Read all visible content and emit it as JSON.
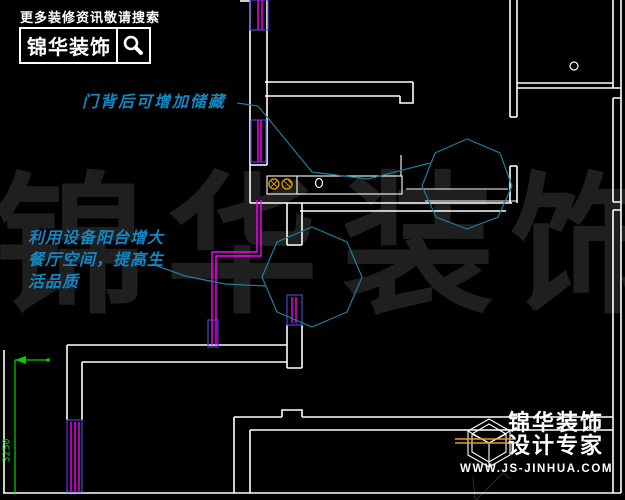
{
  "branding_top": {
    "tagline": "更多装修资讯敬请搜索",
    "brand_name": "锦华装饰",
    "search_icon": "magnifier-icon"
  },
  "annotations": {
    "note1": "门背后可增加储藏",
    "note2_line1": "利用设备阳台增大",
    "note2_line2": "餐厅空间，提高生",
    "note2_line3": "活品质",
    "text_color": "#1486c2",
    "line_color": "#1b7f9e"
  },
  "watermark": {
    "chars": [
      "锦",
      "华",
      "装",
      "饰"
    ],
    "color": "#1f1f1f"
  },
  "dimension": {
    "value": "3250",
    "color": "#00d400"
  },
  "branding_bottom": {
    "brand_name": "锦华装饰",
    "slogan": "设计专家",
    "website": "WWW.JS-JINHUA.COM",
    "cube_icon": "cube-logo-icon",
    "accent_color": "#e39b2d"
  },
  "drawing": {
    "background": "#000000",
    "wall_color": "#ffffff",
    "pipe_color": "#ff00ff",
    "door_frame_color": "#4545cd",
    "outlet_color": "#d89600",
    "faint_color": "#303030"
  }
}
